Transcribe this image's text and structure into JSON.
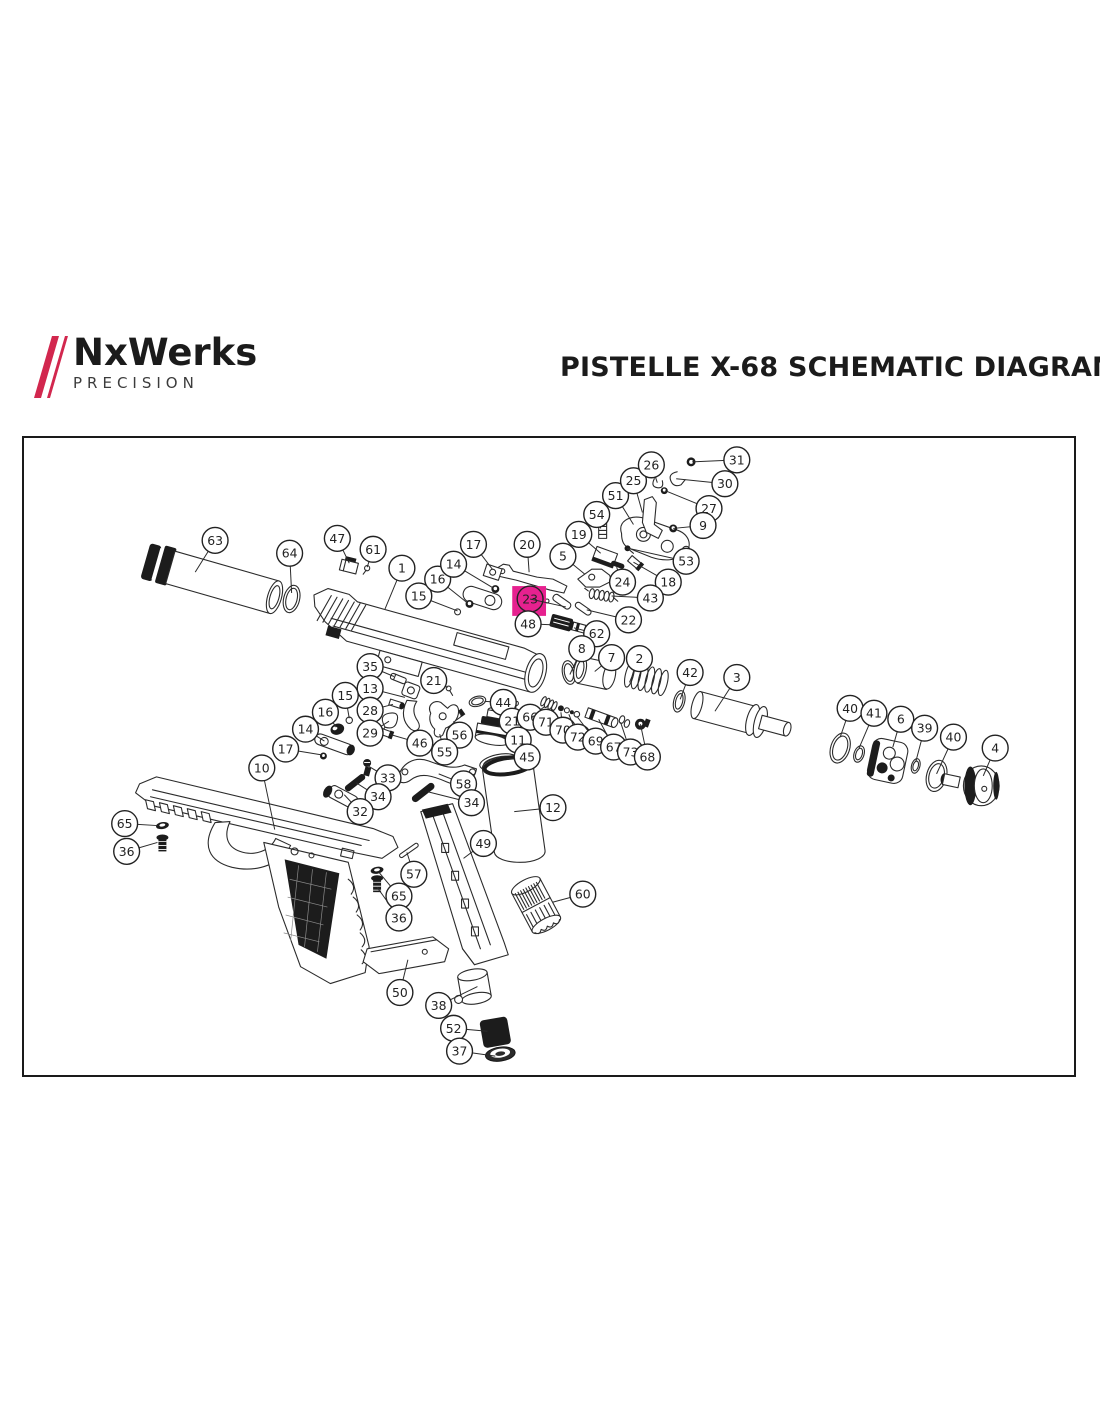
{
  "header": {
    "logo": {
      "brand": "NxWerks",
      "subtitle": "PRECISION",
      "slash_color": "#d2274e",
      "text_color": "#1b1b1b"
    },
    "title": "PISTELLE X-68 SCHEMATIC DIAGRAM"
  },
  "diagram": {
    "border_color": "#1a1a1a",
    "line_color": "#2b2b2b",
    "callout_style": {
      "radius": 13,
      "font_size": 12.5,
      "stroke": "#222222",
      "text_color": "#222222",
      "fill": "#ffffff"
    },
    "highlight": {
      "x": 512,
      "y": 585,
      "width": 34,
      "height": 30,
      "color": "#e6218f",
      "marks_part": "23"
    },
    "callouts": [
      {
        "n": "63",
        "cx": 213,
        "cy": 539,
        "tx": 193,
        "ty": 571
      },
      {
        "n": "64",
        "cx": 288,
        "cy": 552,
        "tx": 290,
        "ty": 592
      },
      {
        "n": "47",
        "cx": 336,
        "cy": 537,
        "tx": 348,
        "ty": 562
      },
      {
        "n": "61",
        "cx": 372,
        "cy": 548,
        "tx": 366,
        "ty": 566
      },
      {
        "n": "1",
        "cx": 401,
        "cy": 567,
        "tx": 384,
        "ty": 608
      },
      {
        "n": "15",
        "cx": 418,
        "cy": 595,
        "tx": 457,
        "ty": 610
      },
      {
        "n": "16",
        "cx": 437,
        "cy": 578,
        "tx": 467,
        "ty": 602
      },
      {
        "n": "14",
        "cx": 453,
        "cy": 563,
        "tx": 493,
        "ty": 587
      },
      {
        "n": "17",
        "cx": 473,
        "cy": 543,
        "tx": 492,
        "ty": 568
      },
      {
        "n": "20",
        "cx": 527,
        "cy": 543,
        "tx": 529,
        "ty": 571
      },
      {
        "n": "5",
        "cx": 563,
        "cy": 555,
        "tx": 585,
        "ty": 573
      },
      {
        "n": "19",
        "cx": 579,
        "cy": 533,
        "tx": 601,
        "ty": 552
      },
      {
        "n": "54",
        "cx": 597,
        "cy": 513,
        "tx": 601,
        "ty": 527
      },
      {
        "n": "51",
        "cx": 616,
        "cy": 494,
        "tx": 634,
        "ty": 523
      },
      {
        "n": "25",
        "cx": 634,
        "cy": 479,
        "tx": 643,
        "ty": 511
      },
      {
        "n": "26",
        "cx": 652,
        "cy": 463,
        "tx": 658,
        "ty": 481
      },
      {
        "n": "31",
        "cx": 738,
        "cy": 458,
        "tx": 693,
        "ty": 460
      },
      {
        "n": "30",
        "cx": 726,
        "cy": 482,
        "tx": 677,
        "ty": 477
      },
      {
        "n": "27",
        "cx": 710,
        "cy": 507,
        "tx": 666,
        "ty": 489
      },
      {
        "n": "9",
        "cx": 704,
        "cy": 524,
        "tx": 674,
        "ty": 527
      },
      {
        "n": "53",
        "cx": 687,
        "cy": 560,
        "tx": 629,
        "ty": 547
      },
      {
        "n": "18",
        "cx": 669,
        "cy": 581,
        "tx": 634,
        "ty": 561
      },
      {
        "n": "24",
        "cx": 623,
        "cy": 581,
        "tx": 617,
        "ty": 566
      },
      {
        "n": "43",
        "cx": 651,
        "cy": 597,
        "tx": 612,
        "ty": 595
      },
      {
        "n": "23",
        "cx": 530,
        "cy": 598,
        "tx": 566,
        "ty": 606,
        "f": "none"
      },
      {
        "n": "22",
        "cx": 629,
        "cy": 619,
        "tx": 587,
        "ty": 609
      },
      {
        "n": "48",
        "cx": 528,
        "cy": 623,
        "tx": 555,
        "ty": 624
      },
      {
        "n": "62",
        "cx": 597,
        "cy": 633,
        "tx": 574,
        "ty": 627
      },
      {
        "n": "8",
        "cx": 582,
        "cy": 648,
        "tx": 570,
        "ty": 674
      },
      {
        "n": "7",
        "cx": 612,
        "cy": 657,
        "tx": 595,
        "ty": 671
      },
      {
        "n": "2",
        "cx": 640,
        "cy": 658,
        "tx": 630,
        "ty": 682
      },
      {
        "n": "42",
        "cx": 691,
        "cy": 672,
        "tx": 681,
        "ty": 699
      },
      {
        "n": "3",
        "cx": 738,
        "cy": 677,
        "tx": 716,
        "ty": 711
      },
      {
        "n": "35",
        "cx": 369,
        "cy": 666,
        "tx": 393,
        "ty": 676
      },
      {
        "n": "21",
        "cx": 433,
        "cy": 680,
        "tx": 447,
        "ty": 687
      },
      {
        "n": "13",
        "cx": 369,
        "cy": 688,
        "tx": 404,
        "ty": 697
      },
      {
        "n": "15",
        "cx": 344,
        "cy": 695,
        "tx": 348,
        "ty": 718
      },
      {
        "n": "28",
        "cx": 369,
        "cy": 710,
        "tx": 392,
        "ty": 704
      },
      {
        "n": "16",
        "cx": 324,
        "cy": 712,
        "tx": 335,
        "ty": 727
      },
      {
        "n": "29",
        "cx": 369,
        "cy": 733,
        "tx": 388,
        "ty": 721
      },
      {
        "n": "14",
        "cx": 304,
        "cy": 729,
        "tx": 323,
        "ty": 741
      },
      {
        "n": "46",
        "cx": 419,
        "cy": 743,
        "tx": 388,
        "ty": 734
      },
      {
        "n": "17",
        "cx": 284,
        "cy": 749,
        "tx": 321,
        "ty": 755
      },
      {
        "n": "56",
        "cx": 459,
        "cy": 735,
        "tx": 453,
        "ty": 721
      },
      {
        "n": "55",
        "cx": 444,
        "cy": 752,
        "tx": 439,
        "ty": 734
      },
      {
        "n": "44",
        "cx": 503,
        "cy": 702,
        "tx": 484,
        "ty": 701
      },
      {
        "n": "21",
        "cx": 512,
        "cy": 721,
        "tx": 515,
        "ty": 706
      },
      {
        "n": "66",
        "cx": 530,
        "cy": 717,
        "tx": 545,
        "ty": 706
      },
      {
        "n": "71",
        "cx": 546,
        "cy": 722,
        "tx": 553,
        "ty": 709
      },
      {
        "n": "70",
        "cx": 563,
        "cy": 730,
        "tx": 561,
        "ty": 712
      },
      {
        "n": "72",
        "cx": 578,
        "cy": 737,
        "tx": 569,
        "ty": 714
      },
      {
        "n": "69",
        "cx": 596,
        "cy": 741,
        "tx": 577,
        "ty": 716
      },
      {
        "n": "67",
        "cx": 614,
        "cy": 747,
        "tx": 599,
        "ty": 719
      },
      {
        "n": "73",
        "cx": 631,
        "cy": 752,
        "tx": 621,
        "ty": 722
      },
      {
        "n": "68",
        "cx": 648,
        "cy": 757,
        "tx": 641,
        "ty": 724
      },
      {
        "n": "11",
        "cx": 518,
        "cy": 740,
        "tx": 501,
        "ty": 736
      },
      {
        "n": "45",
        "cx": 527,
        "cy": 757,
        "tx": 507,
        "ty": 759
      },
      {
        "n": "12",
        "cx": 553,
        "cy": 808,
        "tx": 514,
        "ty": 812
      },
      {
        "n": "58",
        "cx": 463,
        "cy": 784,
        "tx": 438,
        "ty": 774
      },
      {
        "n": "33",
        "cx": 387,
        "cy": 778,
        "tx": 367,
        "ty": 766
      },
      {
        "n": "34",
        "cx": 377,
        "cy": 797,
        "tx": 355,
        "ty": 783
      },
      {
        "n": "32",
        "cx": 359,
        "cy": 812,
        "tx": 343,
        "ty": 795
      },
      {
        "n": "34",
        "cx": 471,
        "cy": 803,
        "tx": 427,
        "ty": 792
      },
      {
        "n": "10",
        "cx": 260,
        "cy": 768,
        "tx": 273,
        "ty": 830
      },
      {
        "n": "65",
        "cx": 122,
        "cy": 824,
        "tx": 155,
        "ty": 826
      },
      {
        "n": "36",
        "cx": 124,
        "cy": 852,
        "tx": 155,
        "ty": 843
      },
      {
        "n": "57",
        "cx": 413,
        "cy": 875,
        "tx": 406,
        "ty": 853
      },
      {
        "n": "65",
        "cx": 398,
        "cy": 897,
        "tx": 377,
        "ty": 872
      },
      {
        "n": "36",
        "cx": 398,
        "cy": 919,
        "tx": 376,
        "ty": 888
      },
      {
        "n": "49",
        "cx": 483,
        "cy": 844,
        "tx": 463,
        "ty": 859
      },
      {
        "n": "60",
        "cx": 583,
        "cy": 895,
        "tx": 553,
        "ty": 903
      },
      {
        "n": "50",
        "cx": 399,
        "cy": 994,
        "tx": 407,
        "ty": 961
      },
      {
        "n": "38",
        "cx": 438,
        "cy": 1007,
        "tx": 477,
        "ty": 988
      },
      {
        "n": "52",
        "cx": 453,
        "cy": 1030,
        "tx": 487,
        "ty": 1033
      },
      {
        "n": "37",
        "cx": 459,
        "cy": 1053,
        "tx": 495,
        "ty": 1058
      },
      {
        "n": "40",
        "cx": 852,
        "cy": 708,
        "tx": 842,
        "ty": 737
      },
      {
        "n": "41",
        "cx": 876,
        "cy": 713,
        "tx": 861,
        "ty": 748
      },
      {
        "n": "6",
        "cx": 903,
        "cy": 719,
        "tx": 895,
        "ty": 747
      },
      {
        "n": "39",
        "cx": 927,
        "cy": 728,
        "tx": 918,
        "ty": 762
      },
      {
        "n": "40",
        "cx": 956,
        "cy": 737,
        "tx": 939,
        "ty": 774
      },
      {
        "n": "4",
        "cx": 998,
        "cy": 748,
        "tx": 986,
        "ty": 776
      }
    ]
  }
}
